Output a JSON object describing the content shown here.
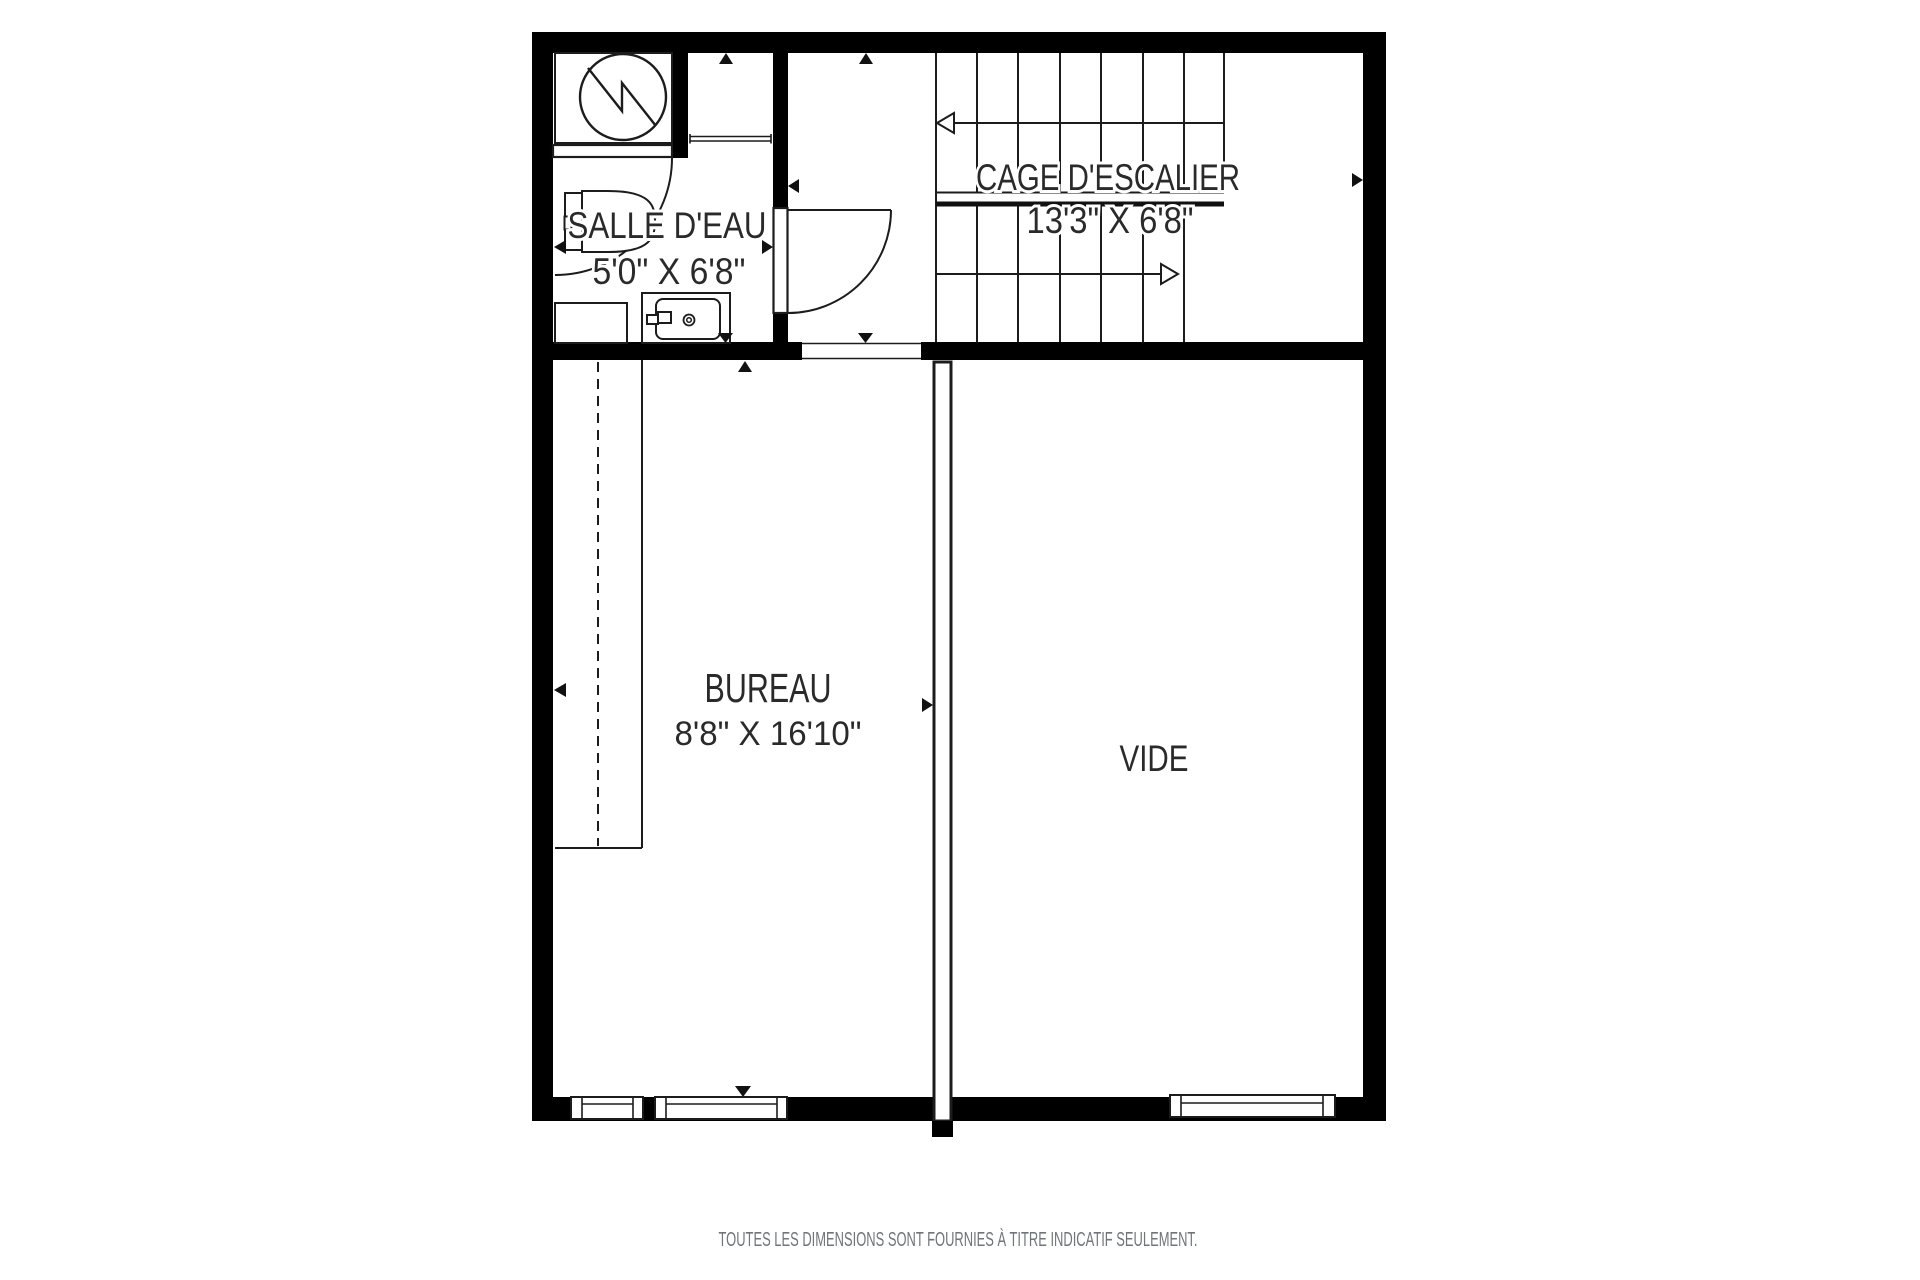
{
  "floor_plan": {
    "type": "residential-floor-plan",
    "language": "fr",
    "rooms": [
      {
        "id": "salle_deau",
        "label": "SALLE D'EAU",
        "dimensions": "5'0\" X 6'8\""
      },
      {
        "id": "cage_escalier",
        "label": "CAGE D'ESCALIER",
        "dimensions": "13'3\" X 6'8\""
      },
      {
        "id": "bureau",
        "label": "BUREAU",
        "dimensions": "8'8\" X 16'10\""
      },
      {
        "id": "vide",
        "label": "VIDE",
        "dimensions": ""
      }
    ],
    "symbols": {
      "water_heater": "circle-with-zigzag",
      "toilet": "tank-and-bowl",
      "sink_vanity": "counter-basin-faucet-drain",
      "doors": "quarter-circle-swing",
      "stair_direction_arrows": "open-triangle-arrows",
      "dimension_markers": "small-filled-triangles",
      "windows": "triple-line-boxes-in-wall",
      "closet_rod": "dashed-line"
    },
    "disclaimer": "TOUTES LES DIMENSIONS SONT FOURNIES À TITRE INDICATIF SEULEMENT."
  },
  "colors": {
    "wall": "#000000",
    "line": "#1c1c1c",
    "text": "#2a2a2a",
    "muted_text": "#70757a",
    "background": "#ffffff"
  }
}
